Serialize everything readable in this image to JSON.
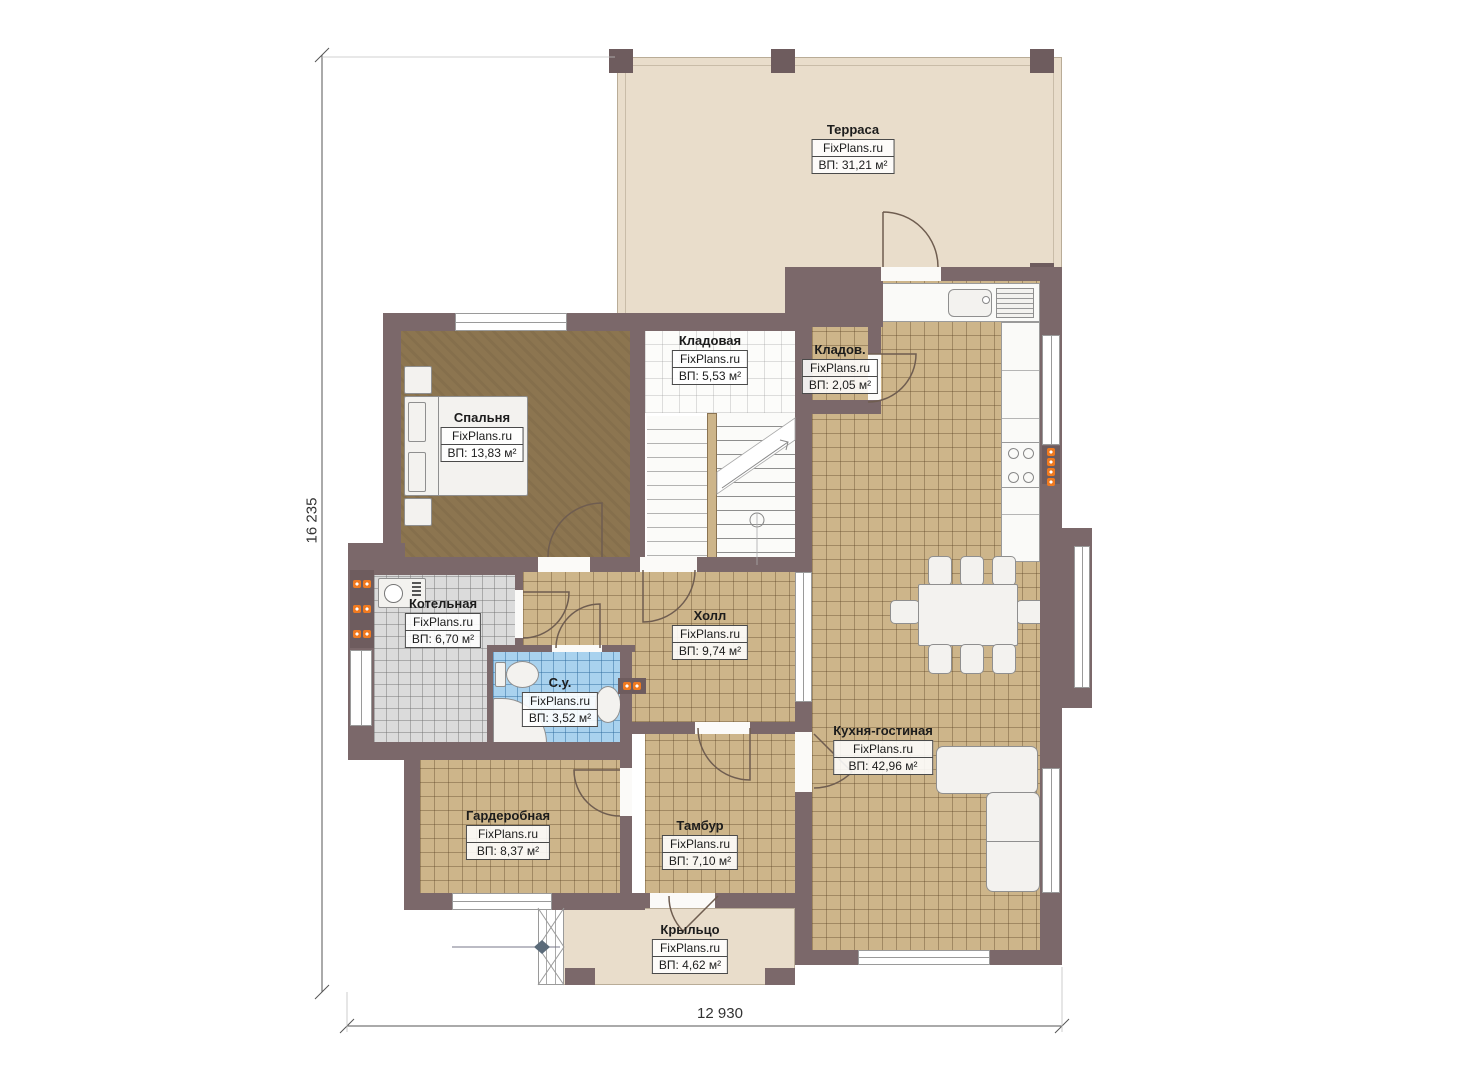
{
  "watermark": "FixPlans.ru",
  "dimensions": {
    "vertical": "16 235",
    "horizontal": "12 930"
  },
  "rooms": {
    "terrace": {
      "name": "Терраса",
      "area": "ВП: 31,21 м²"
    },
    "storage": {
      "name": "Кладовая",
      "area": "ВП: 5,53 м²"
    },
    "storage_small": {
      "name": "Кладов.",
      "area": "ВП: 2,05 м²"
    },
    "bedroom": {
      "name": "Спальня",
      "area": "ВП: 13,83 м²"
    },
    "boiler": {
      "name": "Котельная",
      "area": "ВП: 6,70 м²"
    },
    "hall": {
      "name": "Холл",
      "area": "ВП: 9,74 м²"
    },
    "bathroom": {
      "name": "С.у.",
      "area": "ВП: 3,52 м²"
    },
    "kitchen_living": {
      "name": "Кухня-гостиная",
      "area": "ВП: 42,96 м²"
    },
    "wardrobe": {
      "name": "Гардеробная",
      "area": "ВП: 8,37 м²"
    },
    "vestibule": {
      "name": "Тамбур",
      "area": "ВП: 7,10 м²"
    },
    "porch": {
      "name": "Крыльцо",
      "area": "ВП: 4,62 м²"
    }
  },
  "colors": {
    "wall": "#7b686a",
    "tile_tan": "#cdb58a",
    "bedroom_floor": "#8c7550",
    "tile_gray": "#dbdbdb",
    "tile_blue": "#a9d2ee",
    "terrace": "#e9ddcb",
    "accent_orange": "#f07a20"
  }
}
